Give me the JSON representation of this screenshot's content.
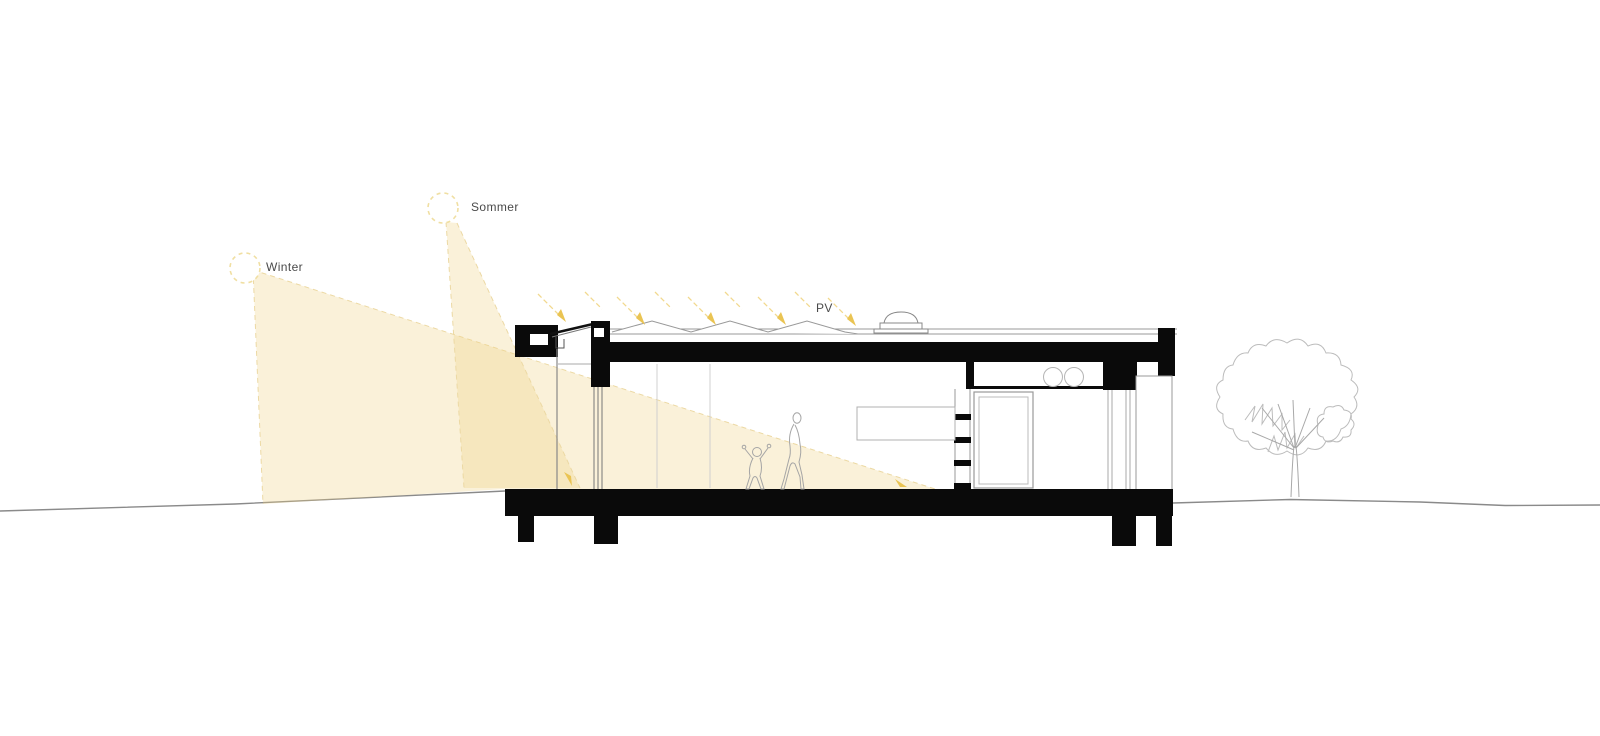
{
  "drawing": {
    "type": "architectural-cross-section",
    "labels": {
      "winter_sun": "Winter",
      "summer_sun": "Sommer",
      "pv": "PV"
    },
    "colors": {
      "sun_stroke": "#f0dfa2",
      "beam_fill": "rgba(240,210,130,0.30)",
      "beam_edge": "#ecd9a4",
      "ray_arrow": "#eac453",
      "label_text": "#4a4a4a",
      "structure_black": "#0a0a0a",
      "thin_line": "#9a9a9a",
      "ground_line": "#8a8a8a",
      "tree_line": "#bcbcbc"
    }
  }
}
